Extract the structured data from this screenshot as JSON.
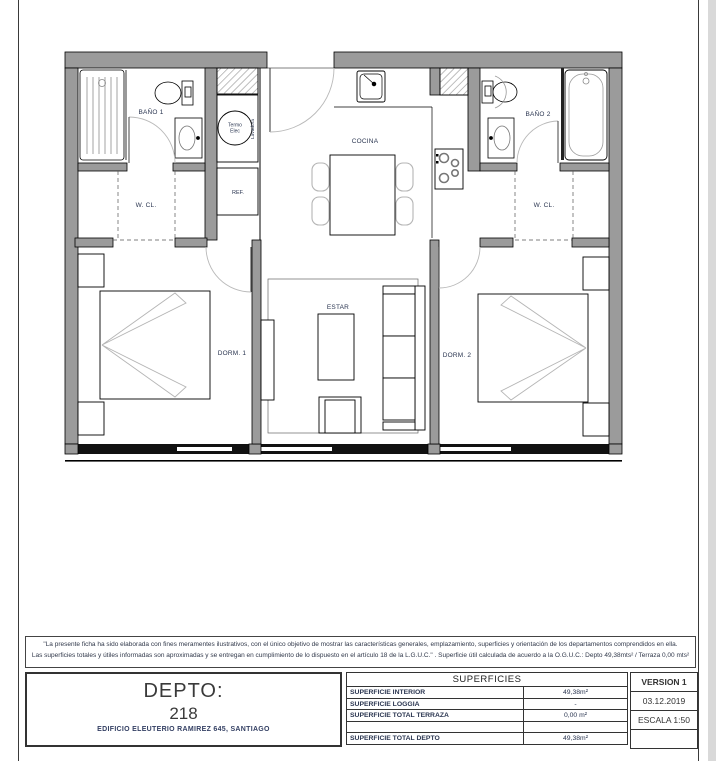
{
  "sheet": {
    "disclaimer_line1": "\"La presente ficha ha sido elaborada con fines meramentes ilustrativos, con el único objetivo de mostrar las características generales, emplazamiento, superficies y orientación de los departamentos comprendidos en ella.",
    "disclaimer_line2": "Las superficies totales y útiles informadas son aproximadas y se entregan en cumplimiento de lo dispuesto en el artículo 18 de la L.G.U.C.\" . Superficie útil calculada de acuerdo a la O.G.U.C.: Depto 49,38mts² / Terraza 0,00 mts²",
    "depto": {
      "label": "DEPTO:",
      "number": "218",
      "building": "EDIFICIO ELEUTERIO RAMIREZ 645, SANTIAGO"
    },
    "superficies": {
      "title": "SUPERFICIES",
      "rows": [
        {
          "label": "SUPERFICIE INTERIOR",
          "value": "49,38m²"
        },
        {
          "label": "SUPERFICIE LOGGIA",
          "value": "-"
        },
        {
          "label": "SUPERFICIE TOTAL TERRAZA",
          "value": "0,00 m²"
        },
        {
          "label": "",
          "value": ""
        },
        {
          "label": "SUPERFICIE TOTAL DEPTO",
          "value": "49,38m²"
        }
      ]
    },
    "version_block": {
      "version": "VERSION 1",
      "date": "03.12.2019",
      "scale": "ESCALA 1:50"
    }
  },
  "plan": {
    "rooms": {
      "bano1": "BAÑO 1",
      "wcl1": "W. CL.",
      "cocina": "COCINA",
      "bano2": "BAÑO 2",
      "wcl2": "W. CL.",
      "dorm1": "DORM. 1",
      "estar": "ESTAR",
      "dorm2": "DORM. 2",
      "ref": "REF.",
      "termo_line1": "Termo",
      "termo_line2": "Elec",
      "lavadora": "Lavadora"
    },
    "colors": {
      "wall_gray": "#9b9b9b",
      "label_navy": "#2a3550",
      "page_band_gray": "#d9d9d9",
      "light_line": "#b5b5b5"
    }
  }
}
